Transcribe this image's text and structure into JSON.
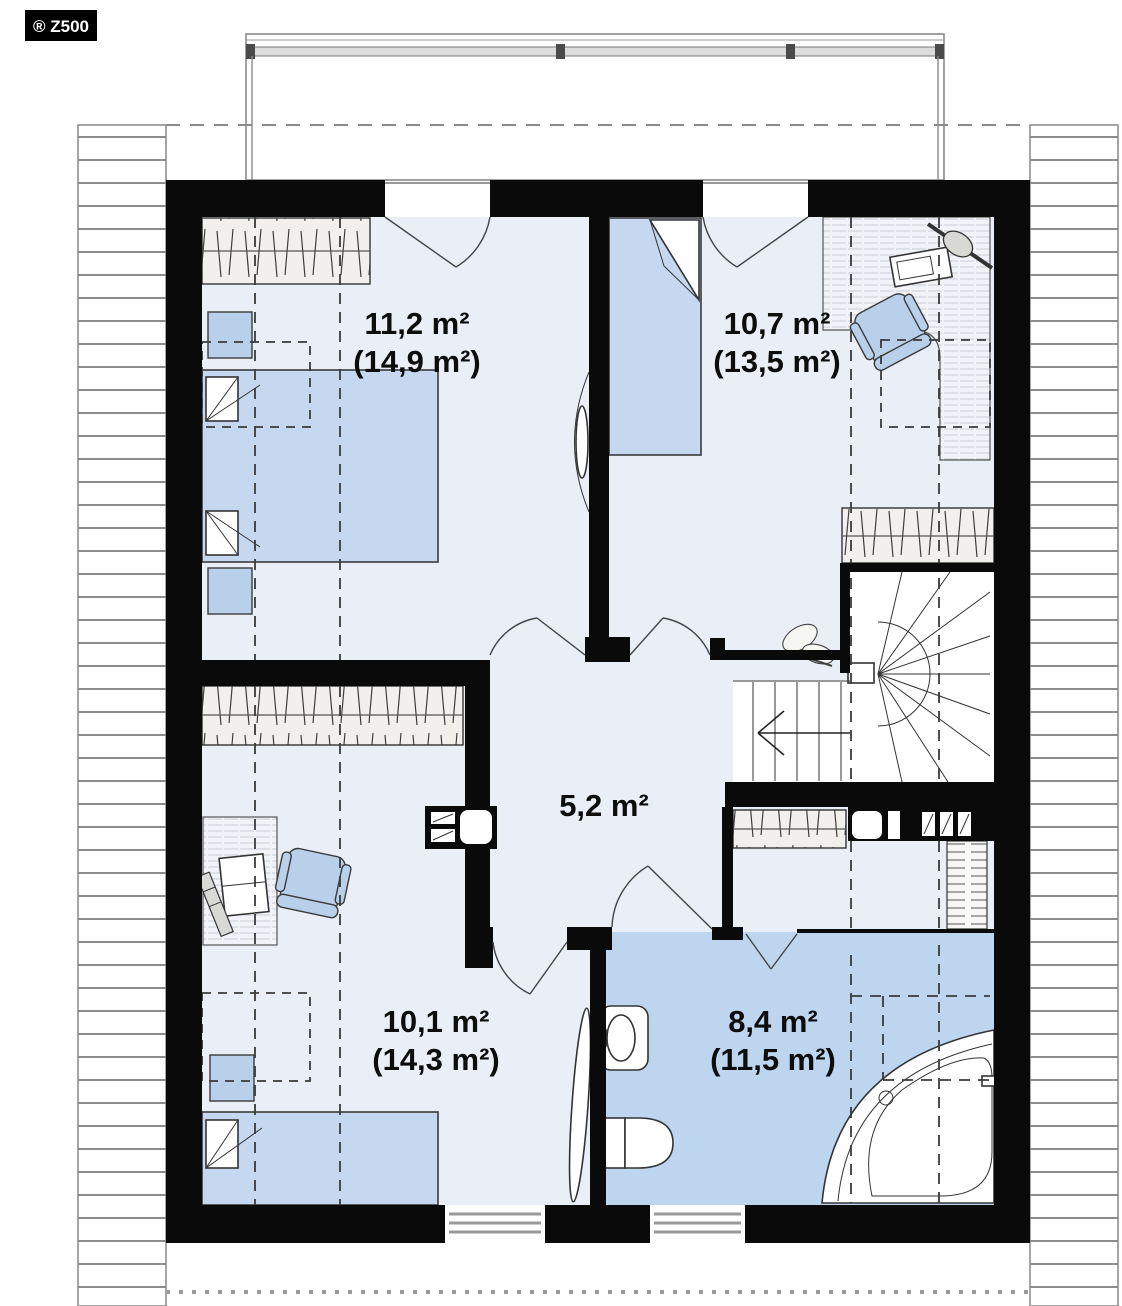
{
  "logo": {
    "text": "® Z500"
  },
  "rooms": {
    "bedroom1": {
      "area": "11,2 m²",
      "total": "(14,9 m²)"
    },
    "bedroom2": {
      "area": "10,7 m²",
      "total": "(13,5 m²)"
    },
    "hall": {
      "area": "5,2 m²"
    },
    "bedroom3": {
      "area": "10,1 m²",
      "total": "(14,3 m²)"
    },
    "bathroom": {
      "area": "8,4 m²",
      "total": "(11,5 m²)"
    }
  },
  "colors": {
    "wall": "#0a0a0a",
    "floor": "#e9eef7",
    "bathFloor": "#bdd5ee",
    "furniture": "#c5d8ef",
    "furnitureDark": "#b9d0ea",
    "outline": "#3a3a3a",
    "logoBg": "#000000",
    "logoText": "#ffffff"
  }
}
